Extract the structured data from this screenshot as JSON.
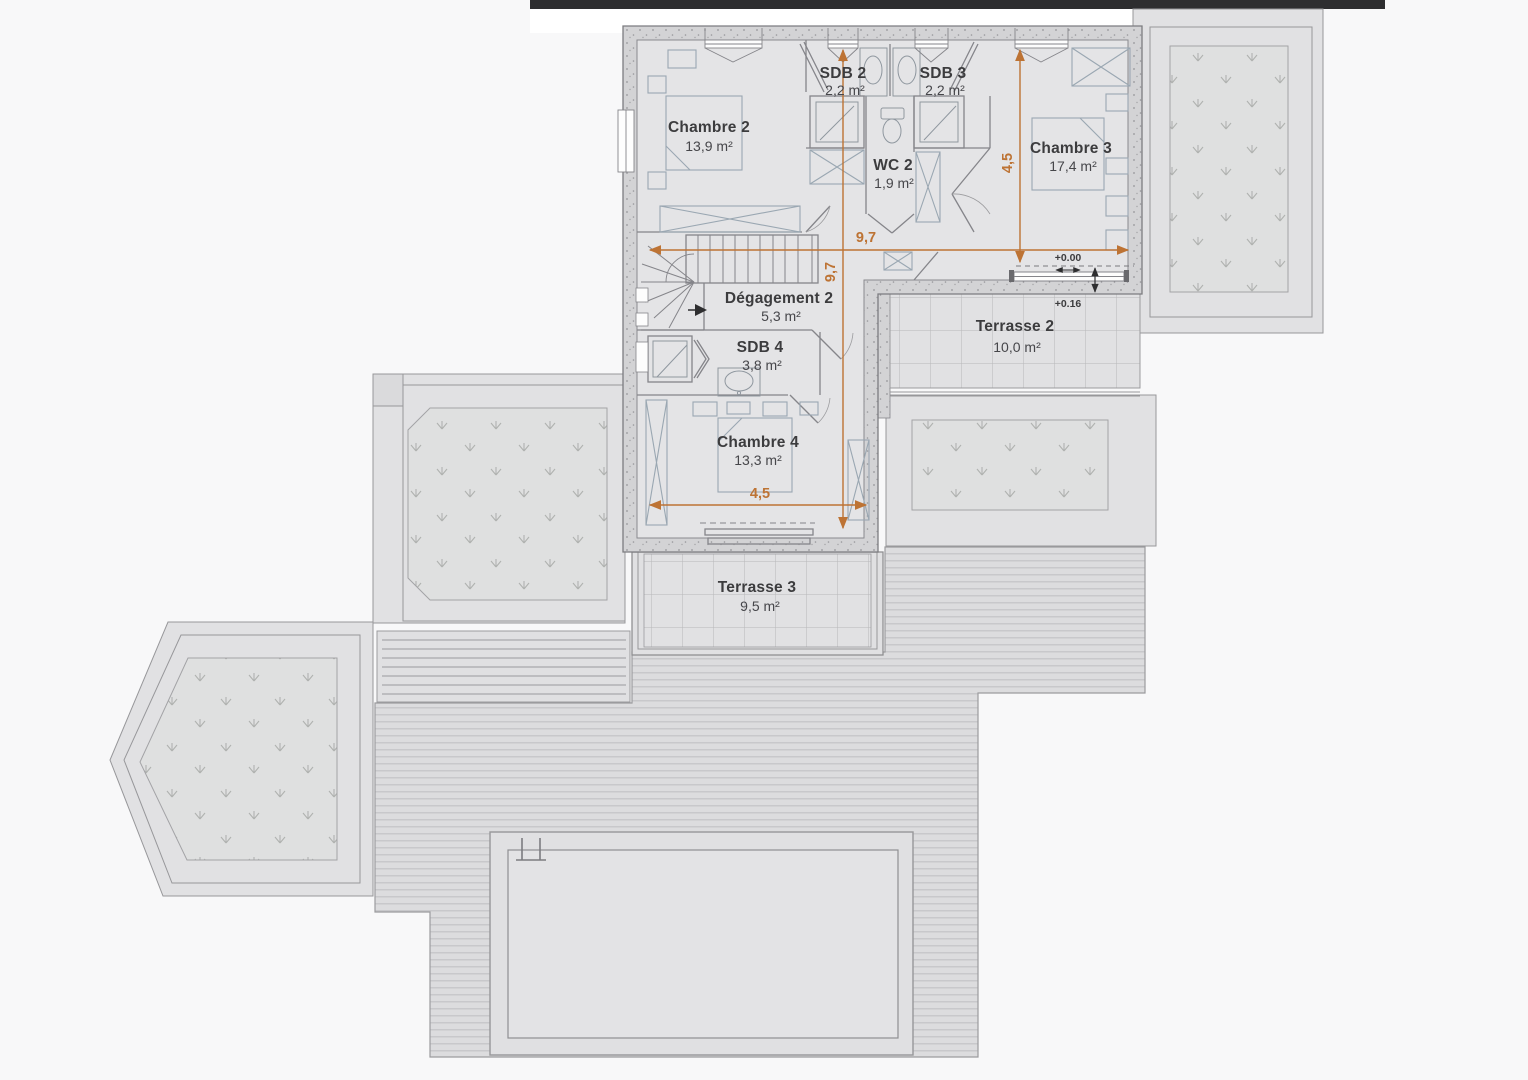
{
  "plan": {
    "type": "architectural-floor-plan",
    "floor": "étage (bedrooms level)",
    "units": "m²"
  },
  "colors": {
    "dimension_orange": "#bd7334",
    "topbar_dark": "#2e2e30",
    "wall_gray": "#d3d3d5",
    "interior_gray": "#e4e4e6",
    "furniture_blue_gray": "#9aa7b2"
  },
  "rooms": [
    {
      "id": "chambre2",
      "name": "Chambre 2",
      "area": "13,9 m²"
    },
    {
      "id": "sdb2",
      "name": "SDB 2",
      "area": "2,2 m²"
    },
    {
      "id": "sdb3",
      "name": "SDB 3",
      "area": "2,2 m²"
    },
    {
      "id": "wc2",
      "name": "WC 2",
      "area": "1,9 m²"
    },
    {
      "id": "chambre3",
      "name": "Chambre 3",
      "area": "17,4 m²"
    },
    {
      "id": "degagement2",
      "name": "Dégagement 2",
      "area": "5,3 m²"
    },
    {
      "id": "sdb4",
      "name": "SDB 4",
      "area": "3,8 m²"
    },
    {
      "id": "chambre4",
      "name": "Chambre 4",
      "area": "13,3 m²"
    },
    {
      "id": "terrasse2",
      "name": "Terrasse 2",
      "area": "10,0 m²"
    },
    {
      "id": "terrasse3",
      "name": "Terrasse 3",
      "area": "9,5 m²"
    }
  ],
  "dims": [
    {
      "label": "9,7",
      "orientation": "horizontal"
    },
    {
      "label": "9,7",
      "orientation": "vertical"
    },
    {
      "label": "4,5",
      "orientation": "vertical"
    },
    {
      "label": "4,5",
      "orientation": "horizontal"
    }
  ],
  "elevations": [
    {
      "label": "+0.00"
    },
    {
      "label": "+0.16"
    }
  ]
}
